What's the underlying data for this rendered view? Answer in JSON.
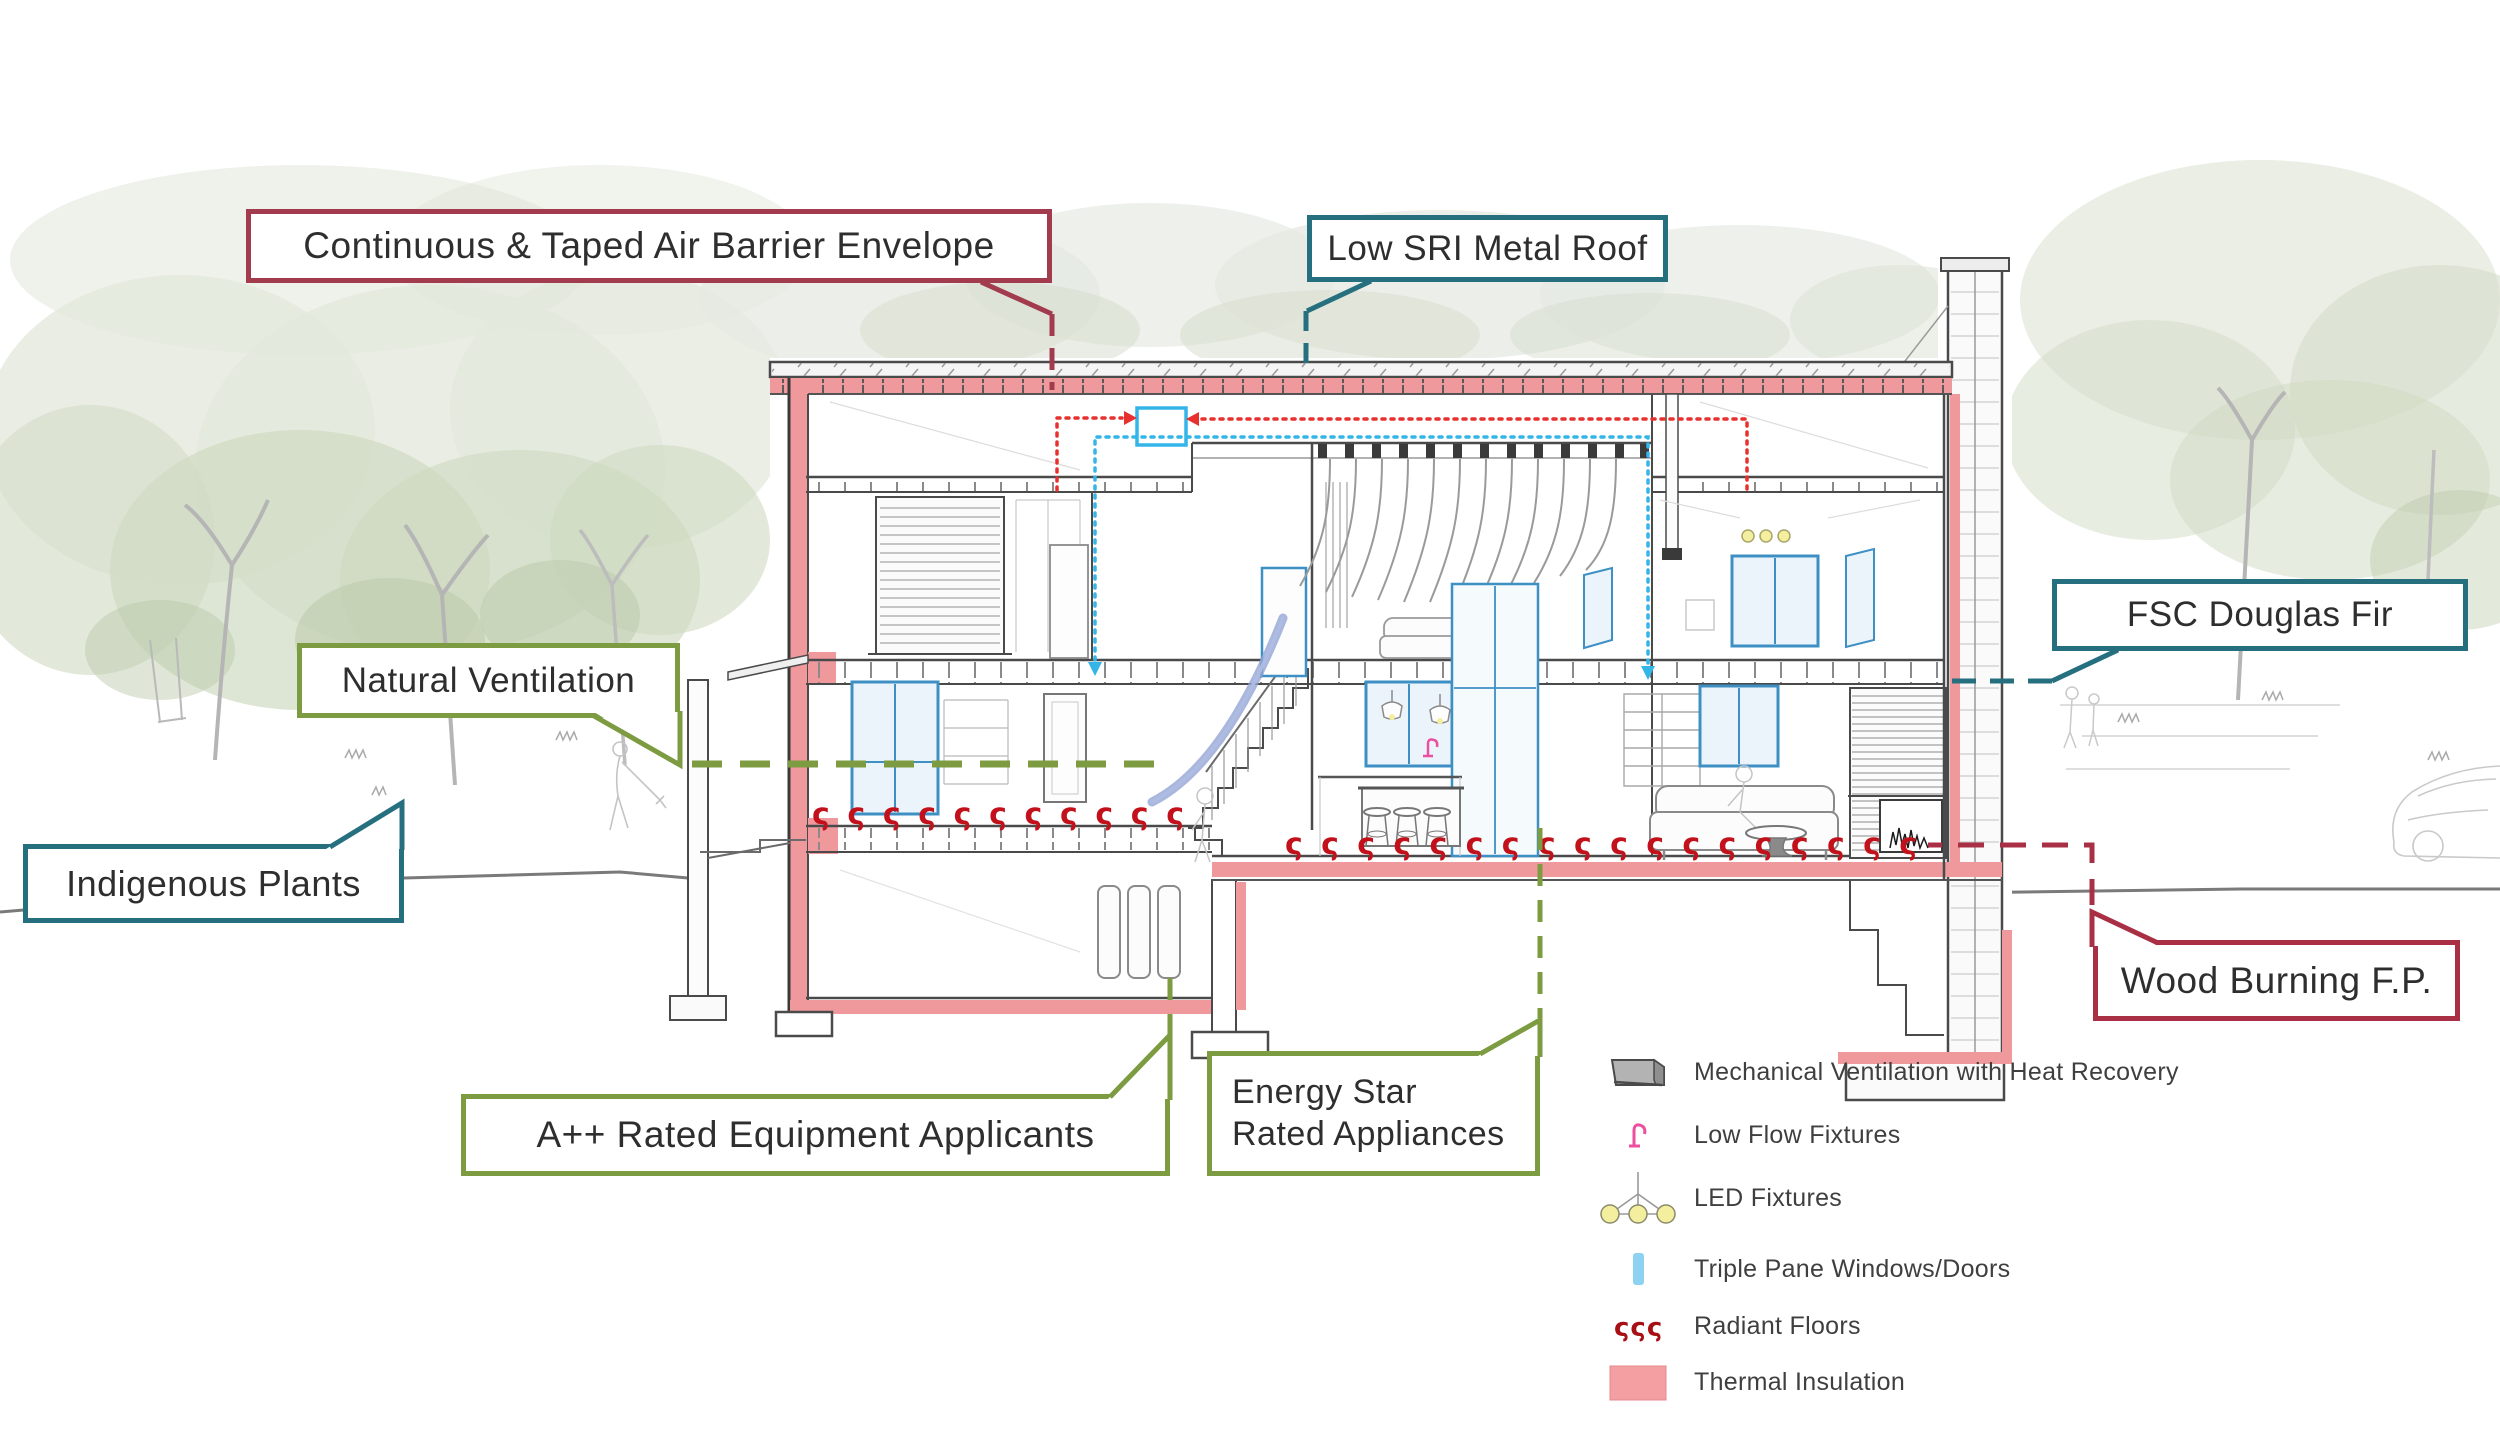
{
  "callouts": {
    "air_barrier": {
      "label": "Continuous & Taped Air Barrier Envelope",
      "color": "#A23B4E"
    },
    "low_sri": {
      "label": "Low SRI Metal Roof",
      "color": "#266F7F"
    },
    "natural_vent": {
      "label": "Natural Ventilation",
      "color": "#7D9B40"
    },
    "indigenous": {
      "label": "Indigenous Plants",
      "color": "#266F7F"
    },
    "fsc": {
      "label": "FSC Douglas Fir",
      "color": "#266F7F"
    },
    "wood_fp": {
      "label": "Wood Burning F.P.",
      "color": "#A93044"
    },
    "a_plus": {
      "label": "A++ Rated Equipment Applicants",
      "color": "#7D9B40"
    },
    "energy_star": {
      "label_line1": "Energy Star",
      "label_line2": "Rated Appliances",
      "color": "#7D9B40"
    }
  },
  "legend": {
    "items": [
      {
        "icon": "hrv-unit-icon",
        "label": "Mechanical Ventilation with Heat Recovery",
        "color": "#B3B3B3"
      },
      {
        "icon": "faucet-icon",
        "label": "Low Flow Fixtures",
        "color": "#EC4FA0"
      },
      {
        "icon": "led-chandelier-icon",
        "label": "LED Fixtures",
        "color": "#F3EF9F"
      },
      {
        "icon": "window-pane-icon",
        "label": "Triple Pane Windows/Doors",
        "color": "#8ED2F2"
      },
      {
        "icon": "radiant-floor-icon",
        "label": "Radiant Floors",
        "color": "#A80F14"
      },
      {
        "icon": "insulation-icon",
        "label": "Thermal Insulation",
        "color": "#F49FA2"
      }
    ]
  },
  "symbols": {
    "radiant_glyph": "ς"
  },
  "colors": {
    "insulation_pink": "#F0999C",
    "radiant_red": "#C2111A",
    "duct_red": "#E8312F",
    "duct_blue": "#33B5E8",
    "window_blue": "#3D8FC4",
    "window_glass": "#EAF4FA",
    "airflow_ribbon": "#93A5D6",
    "ink": "#4A4A4A"
  }
}
